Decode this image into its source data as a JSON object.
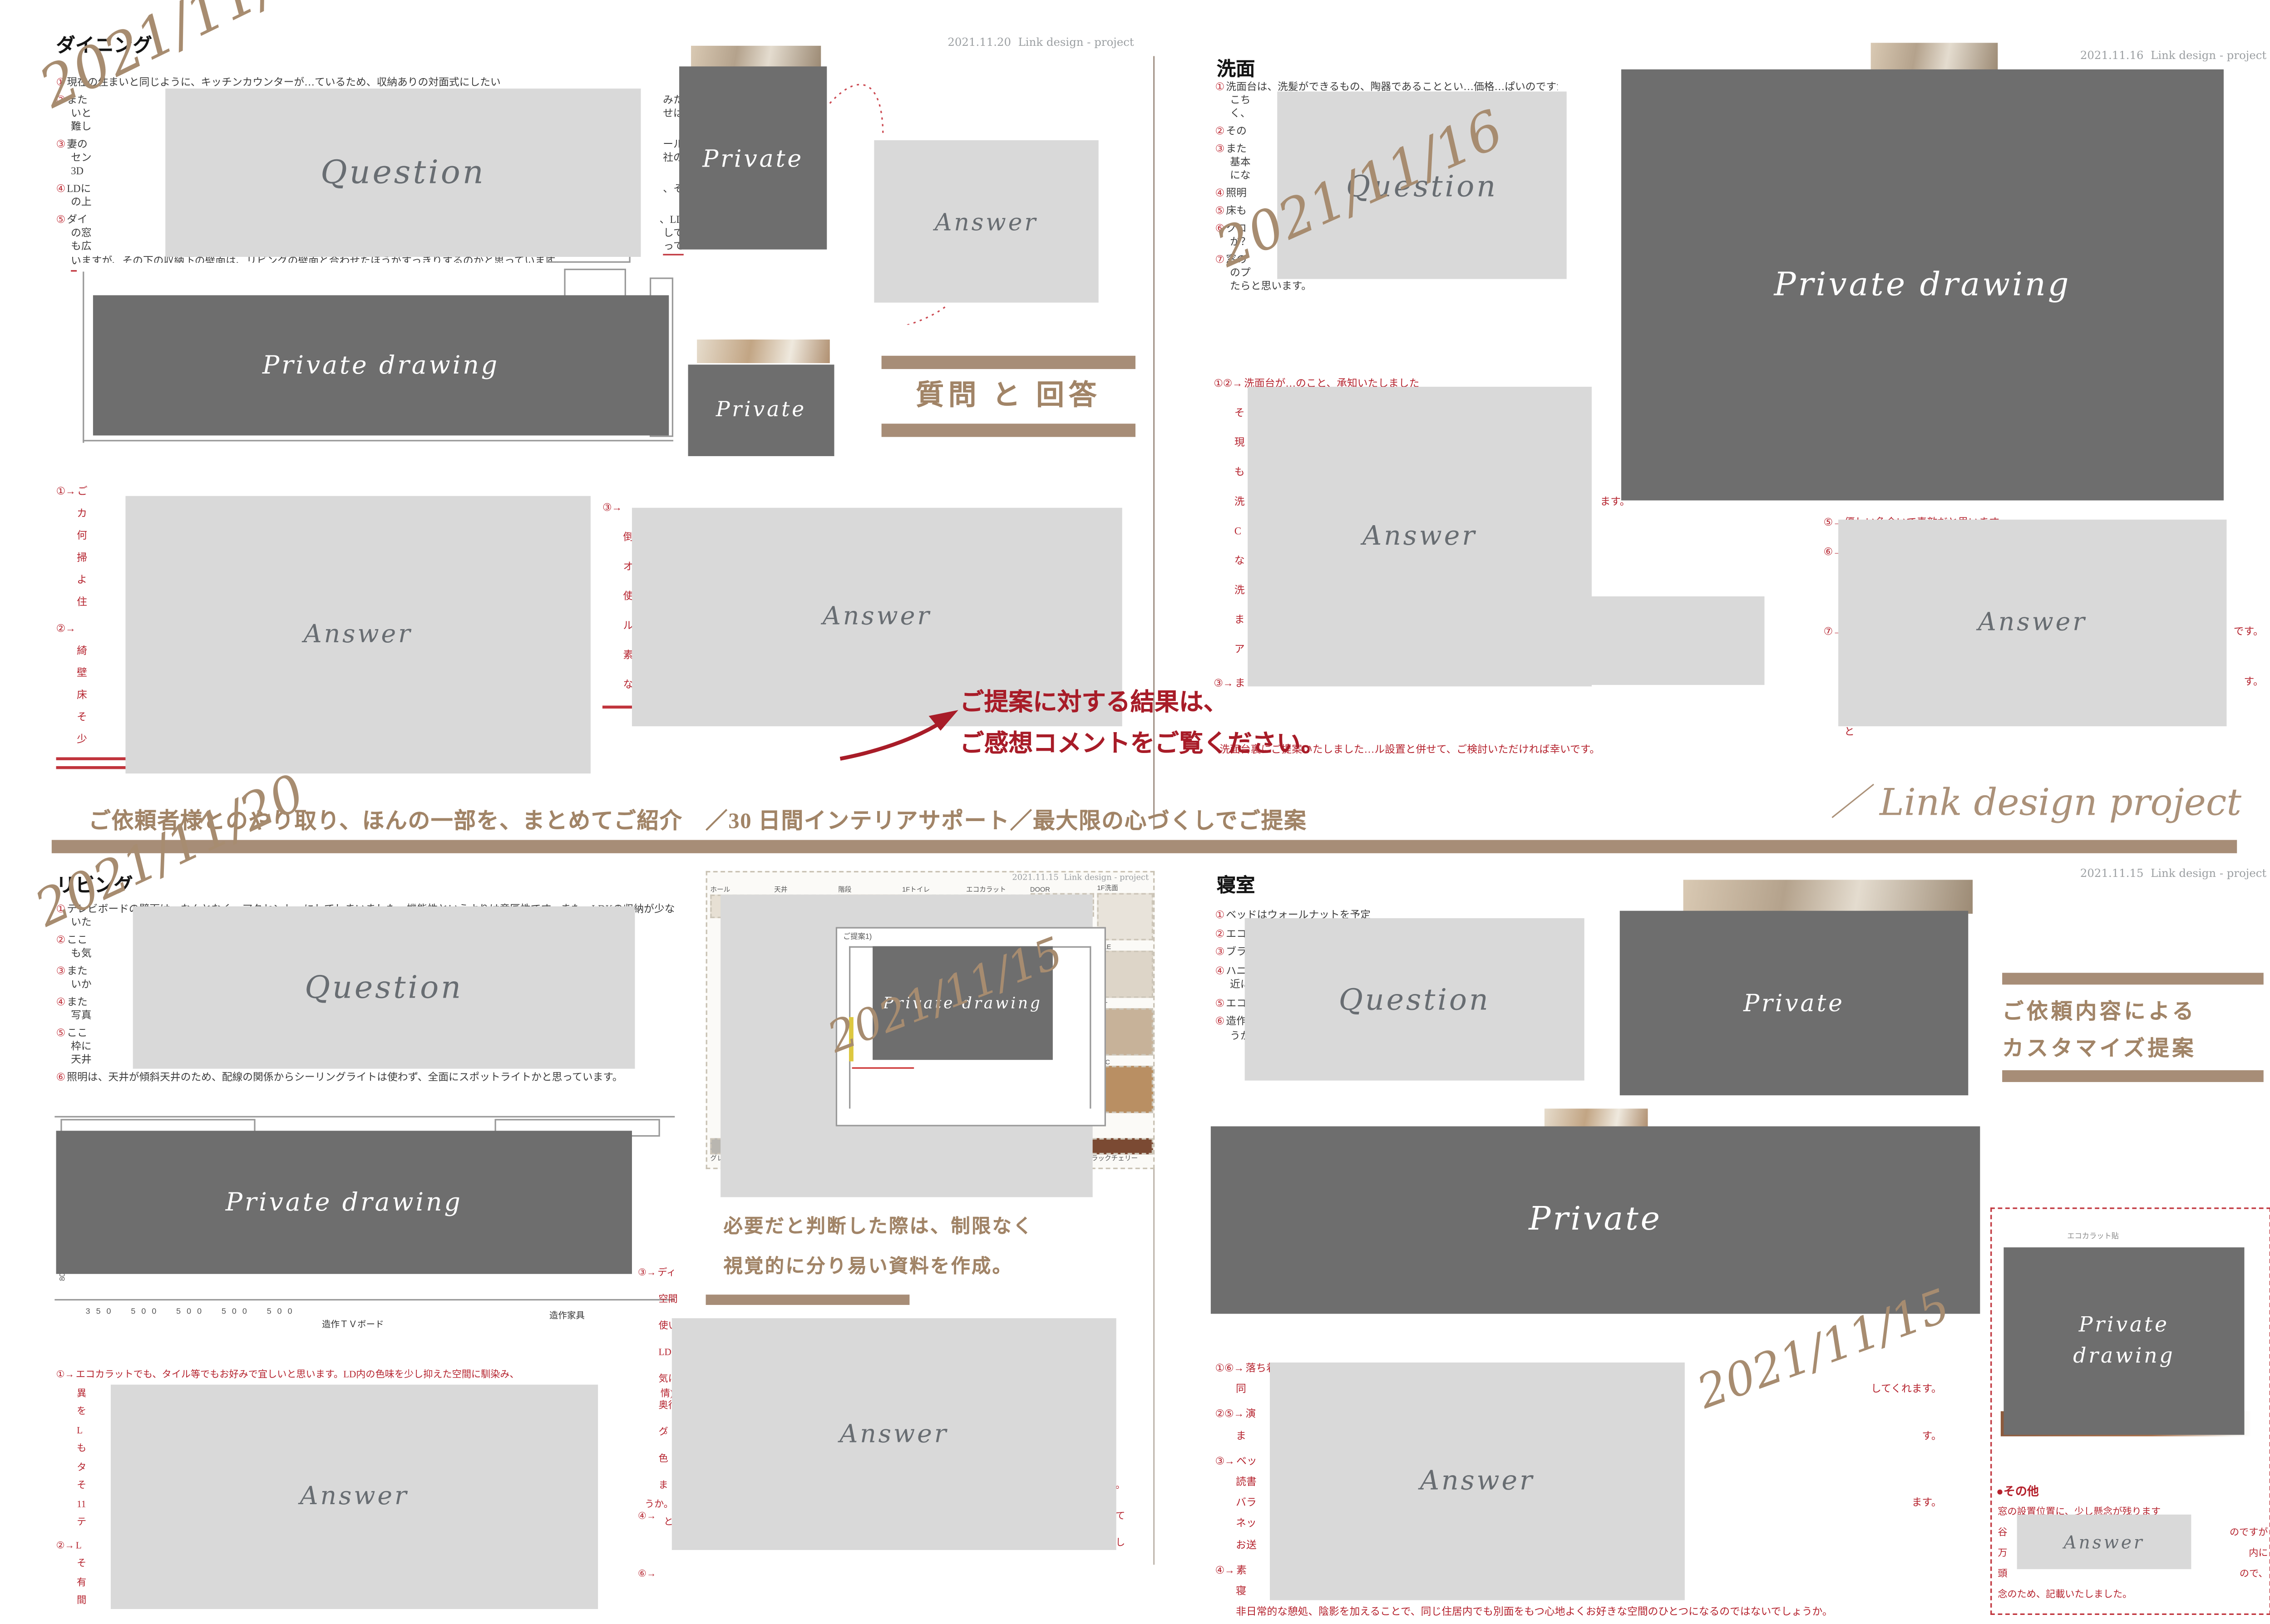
{
  "labels": {
    "question": "Question",
    "answer": "Answer",
    "private": "Private",
    "private_drawing": "Private drawing",
    "private_drawing_2l": "Private\ndrawing"
  },
  "colors": {
    "accent_brown": "#a78d77",
    "accent_red": "#b5232e",
    "light_box": "#d9d9d9",
    "dark_box": "#6e6e6e"
  },
  "dining": {
    "title": "ダイニング",
    "header_date": "2021.11.20",
    "header_brand": "Link design - project",
    "hand_date": "2021/11/20",
    "qa_header": "質問 と 回答",
    "questions": [
      {
        "m": "①",
        "t": "現在の住まいと同じように、キッチンカウンターが…ているため、収納ありの対面式にしたい"
      },
      {
        "m": "②",
        "t": "また",
        "r": "みた",
        "cls": "gap"
      },
      {
        "t": "いと",
        "r": "せは",
        "cls": "ind"
      },
      {
        "t": "難し",
        "cls": "ind"
      },
      {
        "m": "③",
        "t": "妻の",
        "r": "ール",
        "cls": "gap"
      },
      {
        "t": "セン",
        "r": "社の",
        "cls": "ind"
      },
      {
        "t": "3D",
        "cls": "ind"
      },
      {
        "m": "④",
        "t": "LDに",
        "r": "、そ",
        "cls": "gap"
      },
      {
        "t": "の上",
        "cls": "ind"
      },
      {
        "m": "⑤",
        "t": "ダイ",
        "r": "、LD",
        "cls": "gap"
      },
      {
        "t": "の窓",
        "r": "しで",
        "cls": "ind"
      },
      {
        "t": "も広",
        "r": "って",
        "cls": "ind ur"
      },
      {
        "t": "いますが、その下の収納下の壁面は、リビングの壁面と合わせたほうがすっきりするのかと思っています。",
        "cls": "ind u"
      }
    ],
    "answers_left": [
      {
        "m": "①→",
        "t": "ご"
      },
      {
        "t": "カ",
        "cls": "ind2"
      },
      {
        "t": "何",
        "cls": "ind2"
      },
      {
        "t": "掃",
        "cls": "ind2"
      },
      {
        "t": "よ",
        "cls": "ind2"
      },
      {
        "t": "住",
        "cls": "ind2"
      },
      {
        "m": "②→",
        "t": "",
        "cls": "gap"
      },
      {
        "t": "綺",
        "cls": "ind2"
      },
      {
        "t": "壁",
        "cls": "ind2"
      },
      {
        "t": "床",
        "cls": "ind2"
      },
      {
        "t": "そ",
        "cls": "ind2"
      },
      {
        "t": "少",
        "cls": "ind2"
      },
      {
        "cls": "bar"
      },
      {
        "cls": "bar bar2"
      }
    ],
    "answers_right": [
      {
        "m": "③→",
        "t": ""
      },
      {
        "t": "倒",
        "cls": "ind2"
      },
      {
        "t": "オ",
        "cls": "ind2"
      },
      {
        "t": "使",
        "cls": "ind2"
      },
      {
        "t": "ル",
        "cls": "ind2"
      },
      {
        "t": "素",
        "cls": "ind2"
      },
      {
        "t": "な",
        "cls": "ind2"
      },
      {
        "cls": "bar"
      }
    ]
  },
  "washroom": {
    "title": "洗面",
    "header_date": "2021.11.16",
    "header_brand": "Link design - project",
    "hand_date": "2021/11/16",
    "questions": [
      {
        "m": "①",
        "t": "洗面台は、洗髪ができるもの、陶器であることとい…価格…ぱいのですが、"
      },
      {
        "t": "こち",
        "r": "な",
        "cls": "ind"
      },
      {
        "t": "く、",
        "cls": "ind"
      },
      {
        "m": "②",
        "t": "その",
        "cls": "gap"
      },
      {
        "m": "③",
        "t": "また",
        "r": "。",
        "cls": "gap"
      },
      {
        "t": "基本",
        "r": "態",
        "cls": "ind"
      },
      {
        "t": "にな",
        "cls": "ind"
      },
      {
        "m": "④",
        "t": "照明",
        "cls": "gap"
      },
      {
        "m": "⑤",
        "t": "床も",
        "cls": "gap"
      },
      {
        "m": "⑥",
        "t": "クロ",
        "r": "う",
        "cls": "gap"
      },
      {
        "t": "か？",
        "r": "、",
        "cls": "ind"
      },
      {
        "m": "⑦",
        "t": "窓の",
        "r": "ミ",
        "cls": "gap"
      },
      {
        "t": "のプ",
        "r": "け",
        "cls": "ind"
      },
      {
        "t": "たらと思います。",
        "cls": "ind"
      }
    ],
    "answers_left": [
      {
        "m": "①②→",
        "t": "洗面台が…のこと、承知いたしました"
      },
      {
        "t": "そ",
        "cls": "ind2"
      },
      {
        "t": "現",
        "cls": "ind2"
      },
      {
        "t": "も",
        "cls": "ind2"
      },
      {
        "t": "洗",
        "r": "ます。",
        "cls": "ind2"
      },
      {
        "t": "C",
        "cls": "ind2"
      },
      {
        "t": "な",
        "cls": "ind2"
      },
      {
        "t": "洗",
        "cls": "ind2"
      },
      {
        "t": "ま",
        "cls": "ind2"
      },
      {
        "t": "ア",
        "cls": "ind2"
      },
      {
        "m": "③→",
        "t": "ま",
        "cls": "gap"
      }
    ],
    "answers_right": [
      {
        "m": "⑤→",
        "t": "優しい色合いで素敵だと思います"
      },
      {
        "m": "⑥→",
        "t": "こ",
        "cls": "gap"
      },
      {
        "t": "き",
        "cls": "ind2"
      },
      {
        "t": "遅",
        "cls": "ind2"
      },
      {
        "m": "⑦→",
        "t": "日",
        "r": "です。",
        "cls": "gap"
      },
      {
        "t": "ア",
        "cls": "ind2"
      },
      {
        "t": "と",
        "r": "す。",
        "cls": "ind2"
      },
      {
        "t": "例",
        "cls": "ind2"
      },
      {
        "t": "と",
        "cls": "ind2"
      }
    ],
    "bottom_line": "洗面台裏にご提案いたしました…ル設置と併せて、ご検討いただければ幸いです。"
  },
  "center": {
    "result_note_1": "ご提案に対する結果は、",
    "result_note_2": "ご感想コメントをご覧ください。",
    "band_text": "ご依頼者様とのやり取り、ほんの一部を、まとめてご紹介　／30 日間インテリアサポート／最大限の心づくしでご提案",
    "band_brand": "／ Link design project"
  },
  "living": {
    "title": "リビング",
    "hand_date": "2021/11/20",
    "questions": [
      {
        "m": "①",
        "t": "テレビボードの壁面は、なんとなく、アクセント…にしてしまいました。機能性というよりは意匠性です。また、LDKの収納が少な"
      },
      {
        "t": "いた",
        "cls": "ind"
      },
      {
        "m": "②",
        "t": "ここ",
        "r": "ンス",
        "cls": "gap"
      },
      {
        "t": "も気",
        "cls": "ind"
      },
      {
        "m": "③",
        "t": "また",
        "r": "、い",
        "cls": "gap"
      },
      {
        "t": "いか",
        "cls": "ind"
      },
      {
        "m": "④",
        "t": "また",
        "r": "り、",
        "cls": "gap"
      },
      {
        "t": "写真",
        "cls": "ind"
      },
      {
        "m": "⑤",
        "t": "ここ",
        "r": "、木",
        "cls": "gap"
      },
      {
        "t": "枠に",
        "r": "と、",
        "cls": "ind"
      },
      {
        "t": "天井",
        "cls": "ind"
      },
      {
        "m": "⑥",
        "t": "照明は、天井が傾斜天井のため、配線の関係からシーリングライトは使わず、全面にスポットライトかと思っています。",
        "cls": "gap"
      }
    ],
    "drawing": {
      "dims": "350　500　500　500　500",
      "label_tv": "造作ＴＶボード",
      "label_kagu": "造作家具",
      "label_80": "80"
    },
    "answers_left": [
      {
        "m": "①→",
        "t": "エコカラットでも、タイル等でもお好みで宜しいと思います。LD内の色味を少し抑えた空間に馴染み、"
      },
      {
        "t": "異",
        "r": "情)",
        "cls": "ind2"
      },
      {
        "t": "を",
        "cls": "ind2"
      },
      {
        "t": "L",
        "r": "。",
        "cls": "ind2"
      },
      {
        "t": "も",
        "cls": "ind2"
      },
      {
        "t": "タ",
        "cls": "ind2"
      },
      {
        "t": "そ",
        "cls": "ind2"
      },
      {
        "t": "11",
        "r": "うか。",
        "cls": "ind2"
      },
      {
        "t": "テ",
        "r": "と",
        "cls": "ind2"
      },
      {
        "m": "②→",
        "t": "L",
        "cls": "gap"
      },
      {
        "t": "そ",
        "cls": "ind2"
      },
      {
        "t": "有",
        "cls": "ind2"
      },
      {
        "t": "間",
        "cls": "ind2"
      }
    ],
    "answers_right": [
      {
        "m": "③→",
        "t": "ディ"
      },
      {
        "t": "空間",
        "cls": "ind2"
      },
      {
        "t": "使い",
        "cls": "ind2"
      },
      {
        "t": "LD",
        "cls": "ind2"
      },
      {
        "t": "気に",
        "cls": "ind2"
      },
      {
        "t": "奥行",
        "cls": "ind2"
      },
      {
        "t": "グ",
        "cls": "ind2"
      },
      {
        "t": "色",
        "cls": "ind2"
      },
      {
        "t": "ま",
        "r": "ます。",
        "cls": "ind2"
      },
      {
        "m": "④→",
        "t": "",
        "r": "して",
        "cls": "gap"
      },
      {
        "t": "",
        "r": "し",
        "cls": "ind2"
      },
      {
        "m": "⑥→",
        "t": "",
        "cls": "gap"
      }
    ]
  },
  "moodboard": {
    "mini_date": "2021.11.15",
    "mini_brand": "Link design - project",
    "plan_label": "ご提案1)",
    "hand_date": "2021/11/15",
    "caption1": "必要だと判断した際は、制限なく",
    "caption2": "視覚的に分り易い資料を作成。",
    "top_cells": [
      {
        "label": "ホール",
        "color": "#e7e0d4"
      },
      {
        "label": "天井",
        "color": "#efece6"
      },
      {
        "label": "階段",
        "color": "#c9a87c"
      },
      {
        "label": "1Fトイレ",
        "color": "#e3ddd2"
      },
      {
        "label": "エコカラット",
        "color": "#d9d2c6"
      },
      {
        "label": "DOOR",
        "color": "#f0eee9"
      }
    ],
    "right_cells": [
      {
        "label": "1F洗面",
        "color": "#e8e3da"
      },
      {
        "label": "TILE",
        "color": "#ddd5c8"
      },
      {
        "label": "WT",
        "color": "#c7b299"
      },
      {
        "label": "WIC",
        "color": "#b98f63"
      }
    ],
    "bottom_cells": [
      {
        "label": "グレー",
        "color": "#b9b6b0"
      },
      {
        "label": "B案：オンデマンドエコカラット",
        "color": "#ece7dd"
      },
      {
        "label": "21",
        "color": "#d9c9ae"
      },
      {
        "label": "RM673",
        "color": "#cfc4b2"
      },
      {
        "label": "チェスナット",
        "color": "#a9713f"
      },
      {
        "label": "ブラックチェリー",
        "color": "#7b4a33"
      }
    ]
  },
  "bedroom": {
    "title": "寝室",
    "header_date": "2021.11.15",
    "header_brand": "Link design - project",
    "hand_date": "2021/11/15",
    "customize_line1": "ご依頼内容による",
    "customize_line2": "カスタマイズ提案",
    "right_note": "エコカラット貼",
    "questions": [
      {
        "m": "①",
        "t": "ベッドはウォールナットを予定"
      },
      {
        "m": "②",
        "t": "エコ",
        "cls": "gap"
      },
      {
        "m": "③",
        "t": "ブラ",
        "r": "壁面に。",
        "cls": "gap"
      },
      {
        "m": "④",
        "t": "ハニ",
        "r": "あまり身",
        "cls": "gap"
      },
      {
        "t": "近に",
        "cls": "ind"
      },
      {
        "m": "⑤",
        "t": "エコ",
        "cls": "gap"
      },
      {
        "m": "⑥",
        "t": "造作",
        "r": "材にしよ",
        "cls": "gap"
      },
      {
        "t": "うかと思っています。",
        "cls": "ind"
      }
    ],
    "answers": [
      {
        "m": "①⑥→",
        "t": "落ち着きのある素敵な空間に仕上がると思います。"
      },
      {
        "t": "同",
        "r": "してくれます。",
        "cls": "ind2"
      },
      {
        "m": "②⑤→",
        "t": "演",
        "cls": "gap"
      },
      {
        "t": "ま",
        "r": "す。",
        "cls": "ind2"
      },
      {
        "m": "③→",
        "t": "ベッ",
        "cls": "gap"
      },
      {
        "t": "読書",
        "cls": "ind2"
      },
      {
        "t": "バラ",
        "r": "ます。",
        "cls": "ind2"
      },
      {
        "t": "ネッ",
        "cls": "ind2"
      },
      {
        "t": "お送",
        "cls": "ind2"
      },
      {
        "m": "④→",
        "t": "素",
        "cls": "gap"
      },
      {
        "t": "寝",
        "cls": "ind2"
      },
      {
        "t": "非日常的な憩処、陰影を加えることで、同じ住居内でも別面をもつ心地よくお好きな空間のひとつになるのではないでしょうか。",
        "cls": "ind2"
      }
    ],
    "others_title": "●その他",
    "others": [
      {
        "t": "窓の設置位置に、少し懸念が残ります"
      },
      {
        "t": "谷",
        "r": "のですが"
      },
      {
        "t": "万",
        "r": "内に"
      },
      {
        "t": "頭",
        "r": "ので、"
      },
      {
        "t": "念のため、記載いたしました。"
      }
    ]
  }
}
